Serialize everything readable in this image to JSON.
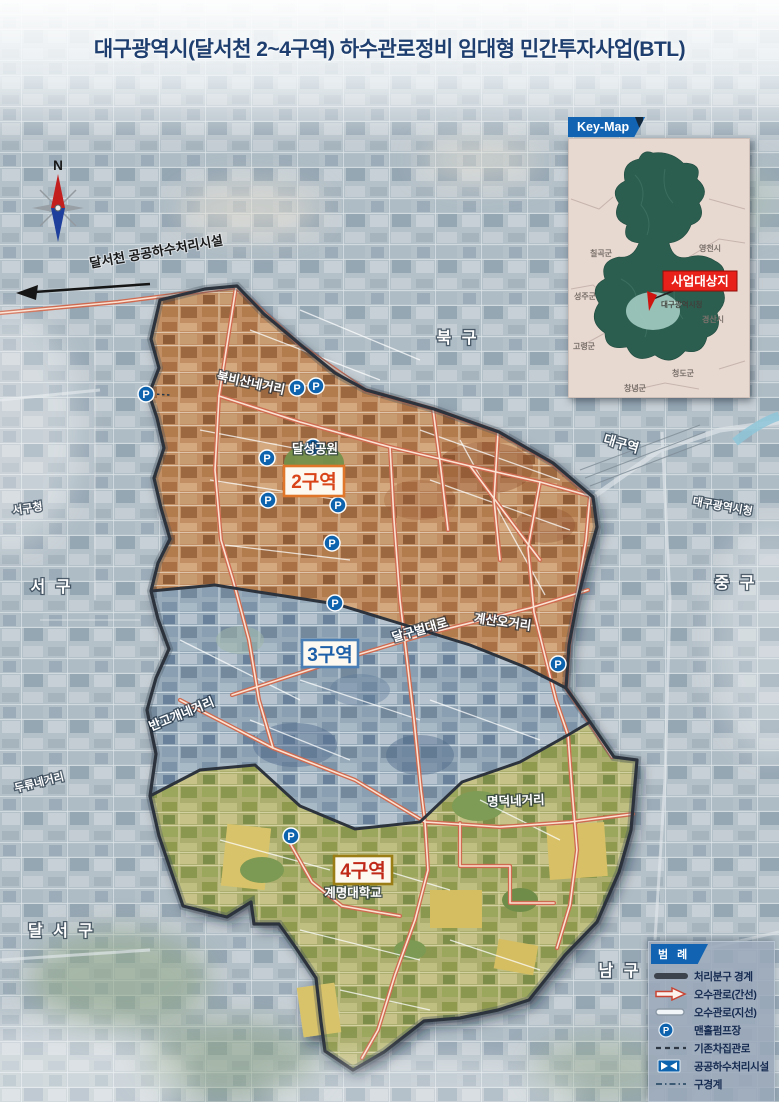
{
  "title": "대구광역시(달서천 2~4구역) 하수관로정비 임대형 민간투자사업(BTL)",
  "compass": {
    "north": "N"
  },
  "plant_label": "달서천 공공하수처리시설",
  "pump_label": "P",
  "zone_labels": {
    "zone2": "2구역",
    "zone3": "3구역",
    "zone4": "4구역"
  },
  "districts": {
    "bukgu": "북 구",
    "seogu": "서 구",
    "junggu": "중 구",
    "dalseogu": "달 서 구",
    "namgu": "남 구"
  },
  "places": {
    "seogu_office": "서구청",
    "daegu_station": "대구역",
    "city_hall": "대구광역시청",
    "dalseong_park": "달성공원",
    "keimyung_univ": "계명대학교"
  },
  "roads": {
    "bukbisan": "북비산네거리",
    "bangogae": "반고개네거리",
    "duryu": "두류네거리",
    "dalgubeol": "달구벌대로",
    "gyesan": "계산오거리",
    "myeongdeok": "명덕네거리"
  },
  "keymap": {
    "title": "Key-Map",
    "target": "사업대상지",
    "city_hall": "대구광역시청",
    "regions": [
      "칠곡군",
      "영천시",
      "성주군",
      "경산시",
      "고령군",
      "청도군",
      "창녕군"
    ]
  },
  "legend": {
    "title": "범 례",
    "items": [
      {
        "label": "처리분구 경계",
        "swatch": "thick-line"
      },
      {
        "label": "오수관로(간선)",
        "swatch": "trunk-arrow"
      },
      {
        "label": "오수관로(지선)",
        "swatch": "branch-bar"
      },
      {
        "label": "맨홀펌프장",
        "swatch": "pump-circle"
      },
      {
        "label": "기존차집관로",
        "swatch": "dashed-line"
      },
      {
        "label": "공공하수처리시설",
        "swatch": "plant-box"
      },
      {
        "label": "구경계",
        "swatch": "dash-dot-line"
      }
    ]
  },
  "colors": {
    "banner_blue": "#1263b2",
    "zone2_border": "#e0762a",
    "zone2_text": "#d94418",
    "zone3_border": "#4a7fb5",
    "zone3_text": "#1d5fa8",
    "zone4_border": "#9a7d15",
    "zone4_text": "#c02818",
    "trunk_line": "#cf6a50",
    "pump_blue": "#0d63ad",
    "target_red": "#e8211a"
  }
}
